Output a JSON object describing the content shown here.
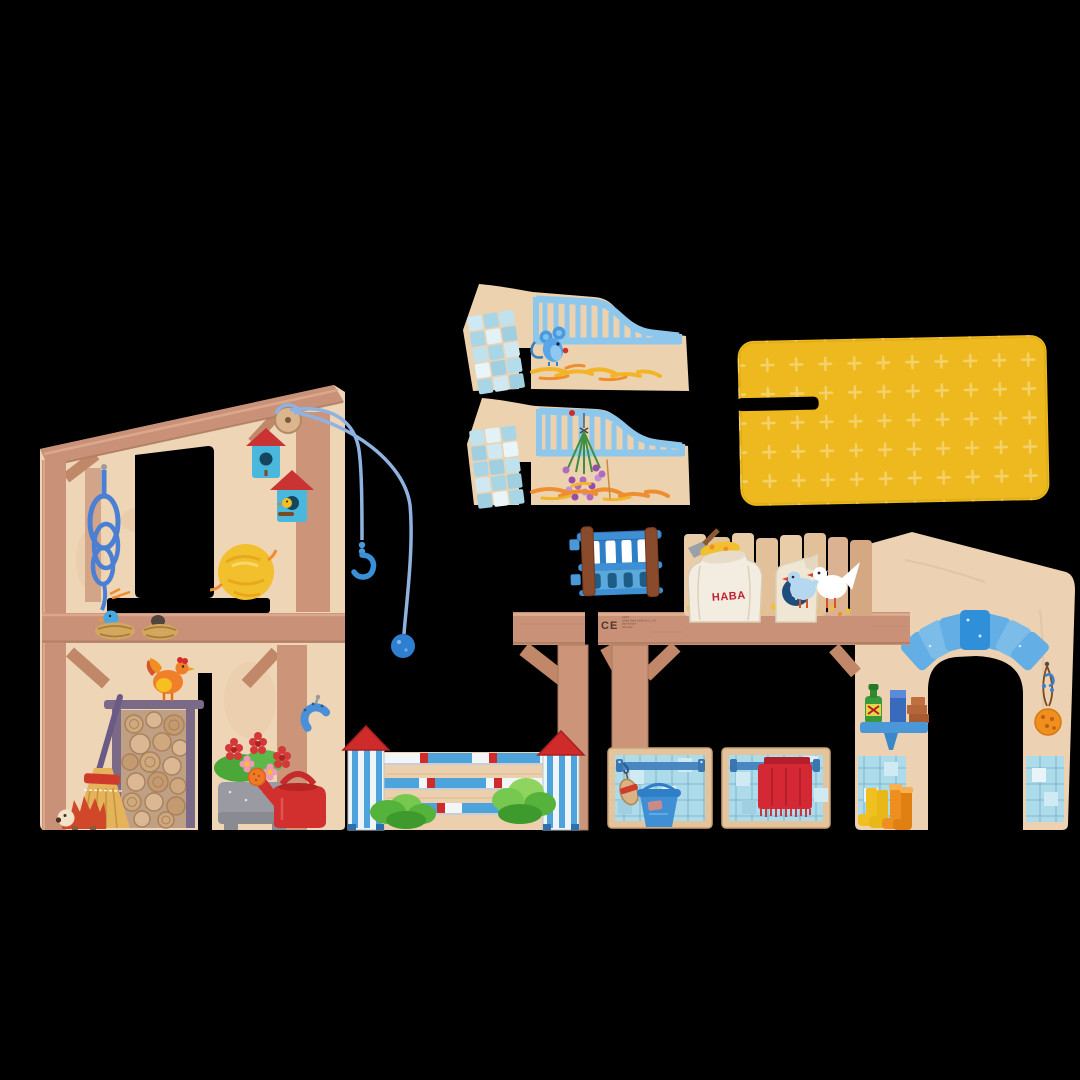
{
  "image": {
    "description": "Product photo on black background: flat wooden pieces of a HABA toy horse-stable playset laid out before assembly",
    "background_color": "#000000"
  },
  "brand": {
    "sack_label": "HABA",
    "ce_mark": "CE",
    "print_lines": [
      "HABA",
      "HABA Sales GmbH & Co. KG",
      "Bad Rodach",
      "Germany"
    ]
  },
  "pieces": [
    {
      "id": "barn-wall",
      "label": "Two-story barn side wall with window, rope, birdhouses, firewood, broom, hedgehog, hen, flower planter and watering can"
    },
    {
      "id": "pulley",
      "label": "Blue pulley cord with hook and ball hanging from barn roof"
    },
    {
      "id": "gate-ramp-top",
      "label": "Stall gate piece with tiled ramp, blue railing, mouse and straw"
    },
    {
      "id": "gate-ramp-bottom",
      "label": "Stall gate piece with tiled ramp, blue railing and lavender bouquet"
    },
    {
      "id": "roof-panel",
      "label": "Yellow roof panel with plus-sign texture and slot"
    },
    {
      "id": "hay-manger",
      "label": "Small blue hay manger rack"
    },
    {
      "id": "stable-wall",
      "label": "Long stable wall with beams, feed sacks, doves, stone archway, tiled stalls, bucket, towel, shelf and boots"
    },
    {
      "id": "jump-fence",
      "label": "Show-jumping fence with two red-roofed towers, striped rails and bushes"
    }
  ],
  "colors": {
    "wood_light": "#eed5b6",
    "wood_mid": "#e3c49c",
    "beam": "#c99178",
    "beam_dark": "#a97a5e",
    "post": "#cc9478",
    "tile": "#aedbe9",
    "tile_dark": "#8fc4d8",
    "rail_light_blue": "#8ec7ec",
    "fence_blue": "#4da3dc",
    "accent_red": "#cf2b2b",
    "towel_red": "#d42835",
    "roof_yellow": "#edb91f",
    "roof_plus": "#f6d472",
    "hay": "#f2c02c",
    "hay_orange": "#ee8e2e",
    "rope_blue": "#4a7fd4",
    "cord_blue": "#8fb2e0",
    "birdhouse_blue": "#49b8dc",
    "stone_blue": "#63aee4",
    "keystone_blue": "#2f8fd8",
    "manger_rail": "#3f8fd4",
    "manger_post": "#8a4a2c",
    "sack": "#f3ece0",
    "haba_red": "#c22233",
    "emblem_blue": "#1d4f7a",
    "dove_blue": "#b5d8f0",
    "white": "#ffffff",
    "bush_green": "#55b23a",
    "bottle_green": "#3a9a3a",
    "brick": "#b5663a",
    "boot_yellow": "#f0c020",
    "boot_orange": "#ef8f1f",
    "planter_grey": "#9a9aa2",
    "broom_straw": "#e5b35c",
    "hedgehog_red": "#d0472a"
  }
}
